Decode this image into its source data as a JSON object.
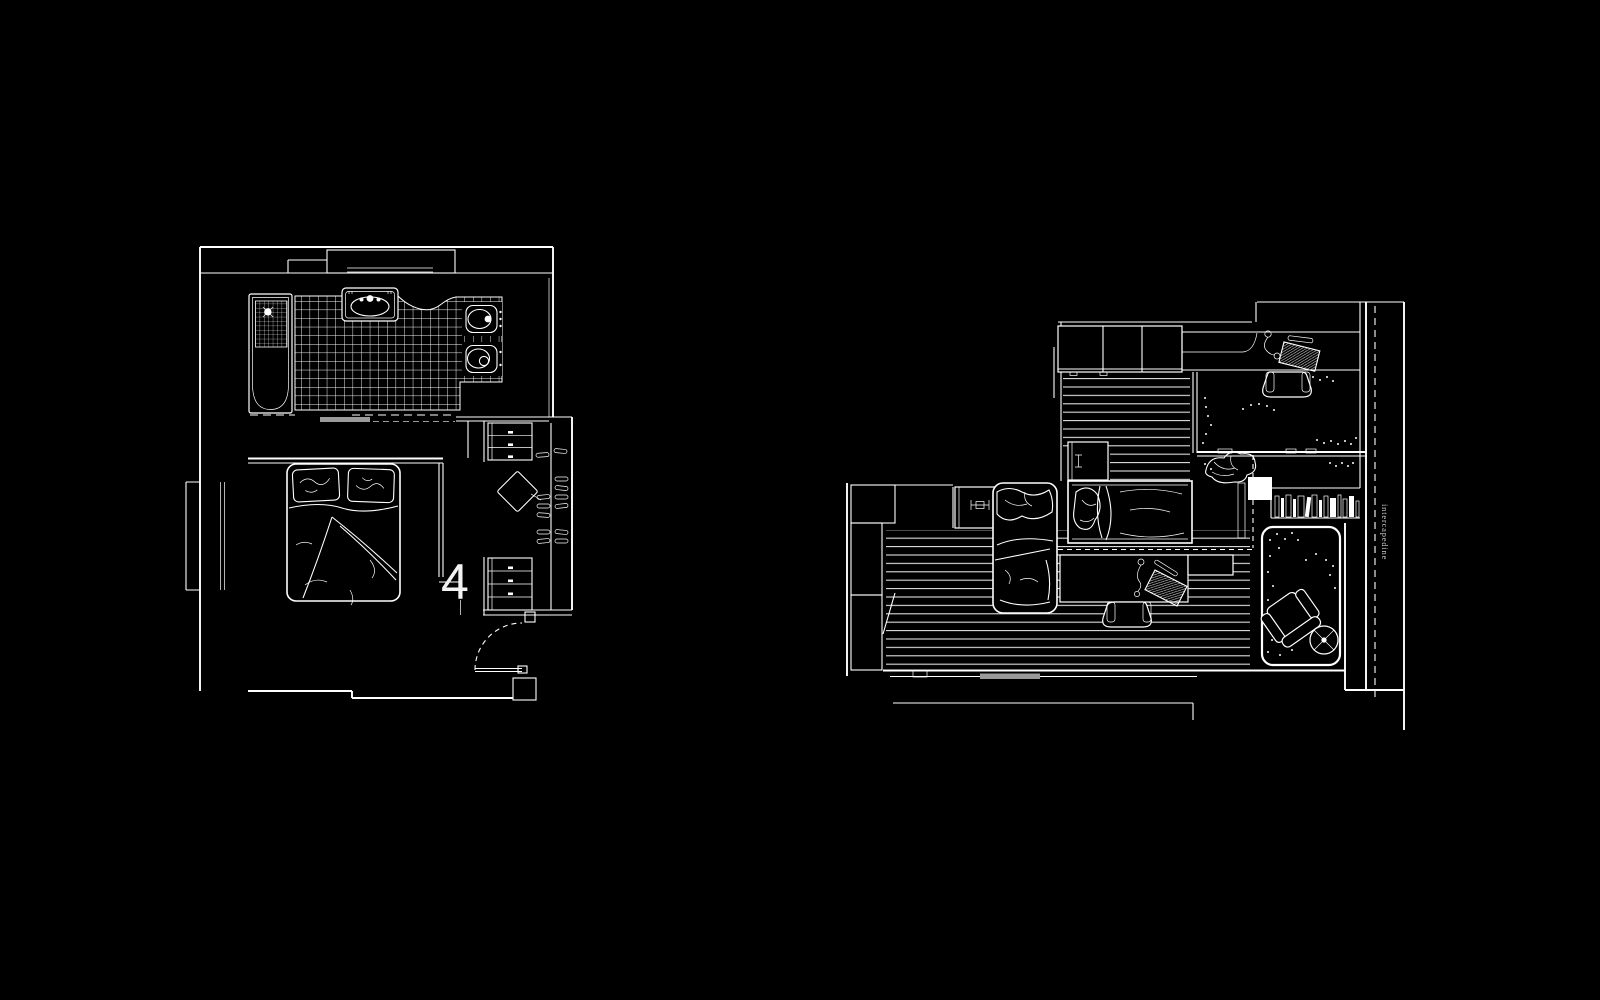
{
  "canvas": {
    "background": "#000000",
    "line_color": "#ffffff",
    "muted_line_color": "#9a9a9a",
    "annotation_text_color": "#c8c8c8"
  },
  "left_plan": {
    "section_label": "4"
  },
  "right_plan": {
    "wall_annotation": "intercapedine"
  }
}
